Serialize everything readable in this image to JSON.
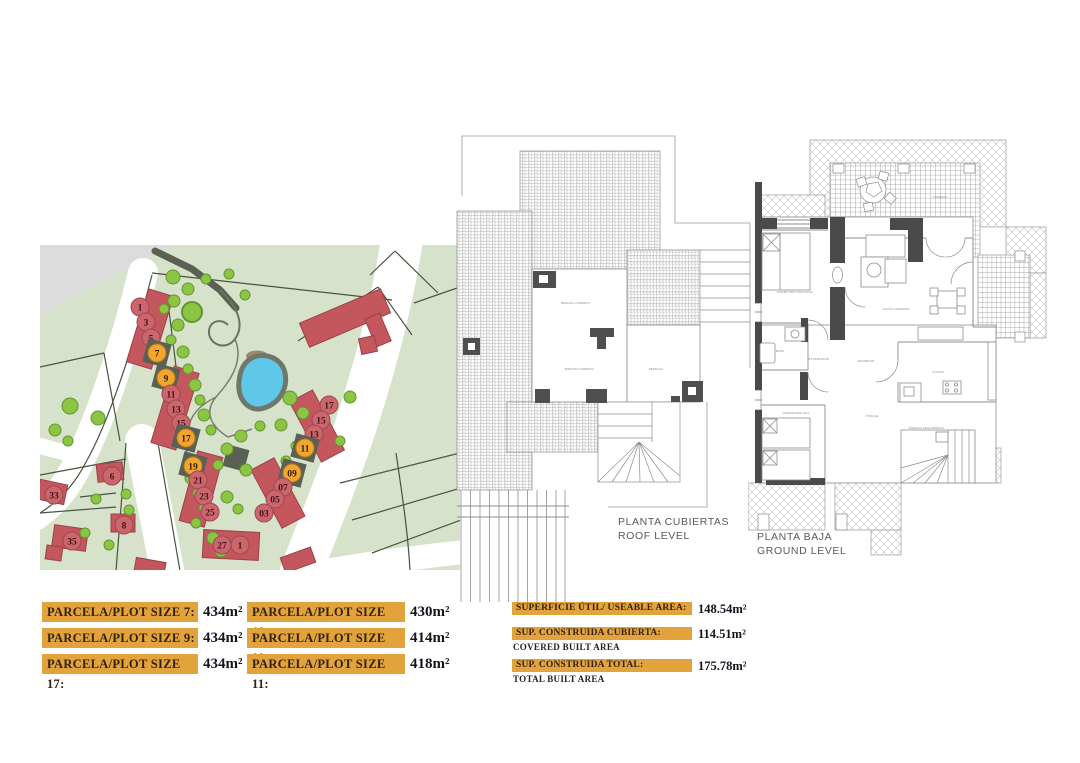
{
  "colors": {
    "bar_orange": "#e2a33d",
    "plot_red": "#c4565e",
    "highlight_orange": "#f2a62f",
    "map_green": "#d6e3ca",
    "pond_blue": "#5fc8e9"
  },
  "site_map": {
    "plots": [
      {
        "label": "1",
        "x": 100,
        "y": 62,
        "highlight": false
      },
      {
        "label": "3",
        "x": 106,
        "y": 77,
        "highlight": false
      },
      {
        "label": "5",
        "x": 111,
        "y": 93,
        "highlight": false
      },
      {
        "label": "7",
        "x": 117,
        "y": 108,
        "highlight": true
      },
      {
        "label": "9",
        "x": 126,
        "y": 133,
        "highlight": true
      },
      {
        "label": "11",
        "x": 131,
        "y": 149,
        "highlight": false
      },
      {
        "label": "13",
        "x": 136,
        "y": 164,
        "highlight": false
      },
      {
        "label": "15",
        "x": 141,
        "y": 178,
        "highlight": false
      },
      {
        "label": "17",
        "x": 146,
        "y": 193,
        "highlight": true
      },
      {
        "label": "19",
        "x": 153,
        "y": 221,
        "highlight": true
      },
      {
        "label": "21",
        "x": 158,
        "y": 235,
        "highlight": false
      },
      {
        "label": "23",
        "x": 164,
        "y": 251,
        "highlight": false
      },
      {
        "label": "25",
        "x": 170,
        "y": 267,
        "highlight": false
      },
      {
        "label": "27",
        "x": 182,
        "y": 300,
        "highlight": false
      },
      {
        "label": "1",
        "x": 200,
        "y": 300,
        "highlight": false
      },
      {
        "label": "17",
        "x": 289,
        "y": 160,
        "highlight": false
      },
      {
        "label": "15",
        "x": 281,
        "y": 175,
        "highlight": false
      },
      {
        "label": "13",
        "x": 274,
        "y": 189,
        "highlight": false
      },
      {
        "label": "11",
        "x": 265,
        "y": 203,
        "highlight": true
      },
      {
        "label": "09",
        "x": 252,
        "y": 228,
        "highlight": true
      },
      {
        "label": "07",
        "x": 243,
        "y": 242,
        "highlight": false
      },
      {
        "label": "05",
        "x": 235,
        "y": 254,
        "highlight": false
      },
      {
        "label": "03",
        "x": 224,
        "y": 268,
        "highlight": false
      },
      {
        "label": "33",
        "x": 14,
        "y": 250,
        "highlight": false
      },
      {
        "label": "6",
        "x": 72,
        "y": 231,
        "highlight": false
      },
      {
        "label": "8",
        "x": 84,
        "y": 280,
        "highlight": false
      },
      {
        "label": "35",
        "x": 32,
        "y": 296,
        "highlight": false
      }
    ]
  },
  "roof_plan": {
    "title_line1": "PLANTA CUBIERTAS",
    "title_line2": "ROOF LEVEL",
    "room_labels": [
      {
        "x": 120,
        "y": 194,
        "t": "TERRAZA CUBIERTA"
      },
      {
        "x": 124,
        "y": 260,
        "t": "TERRAZA CUBIERTA"
      },
      {
        "x": 201,
        "y": 260,
        "t": "PÉRGOLA"
      }
    ]
  },
  "ground_plan": {
    "title_line1": "PLANTA BAJA",
    "title_line2": "GROUND LEVEL",
    "room_labels": [
      {
        "x": 47,
        "y": 173,
        "t": "DORMITORIO PRINCIPAL"
      },
      {
        "x": 32,
        "y": 232,
        "t": "BAÑO"
      },
      {
        "x": 70,
        "y": 240,
        "t": "DISTRIBUIDOR"
      },
      {
        "x": 118,
        "y": 242,
        "t": "RECIBIDOR"
      },
      {
        "x": 148,
        "y": 190,
        "t": "SALÓN COMEDOR"
      },
      {
        "x": 190,
        "y": 253,
        "t": "COCINA"
      },
      {
        "x": 48,
        "y": 294,
        "t": "DORMITORIO DOS"
      },
      {
        "x": 124,
        "y": 297,
        "t": "PORCHE"
      },
      {
        "x": 178,
        "y": 309,
        "t": "TERRAZA DESCUBIERTA"
      },
      {
        "x": 192,
        "y": 78,
        "t": "TERRAZA"
      }
    ]
  },
  "plot_table": {
    "left": [
      {
        "label": "PARCELA/PLOT SIZE 7:",
        "value": "434m²"
      },
      {
        "label": "PARCELA/PLOT SIZE 9:",
        "value": "434m²"
      },
      {
        "label": "PARCELA/PLOT SIZE 17:",
        "value": "434m²"
      }
    ],
    "right": [
      {
        "label": "PARCELA/PLOT SIZE 19:",
        "value": "430m²"
      },
      {
        "label": "PARCELA/PLOT SIZE 09:",
        "value": "414m²"
      },
      {
        "label": "PARCELA/PLOT SIZE 11:",
        "value": "418m²"
      }
    ]
  },
  "area_table": {
    "rows": [
      {
        "label": "SUPERFICIE ÚTIL/ USEABLE AREA:",
        "sublabel": "",
        "value": "148.54m²"
      },
      {
        "label": "SUP. CONSTRUIDA CUBIERTA:",
        "sublabel": "COVERED BUILT AREA",
        "value": "114.51m²"
      },
      {
        "label": "SUP. CONSTRUIDA TOTAL:",
        "sublabel": "TOTAL BUILT AREA",
        "value": "175.78m²"
      }
    ]
  }
}
